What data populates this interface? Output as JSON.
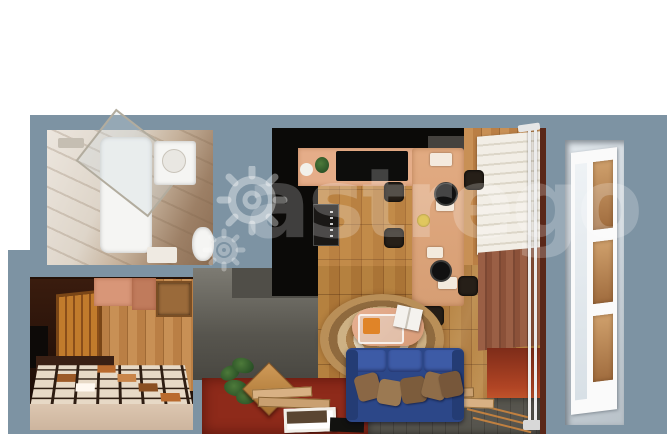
{
  "meta": {
    "type": "3d-floorplan-render",
    "subject": "Top-down 3D render of a furnished studio apartment with balcony",
    "canvas": {
      "width": 670,
      "height": 434
    }
  },
  "watermark": {
    "text": "astrego",
    "icon": "gear-icons",
    "color": "rgba(255,255,255,0.22)"
  },
  "colors": {
    "bg": "#ffffff",
    "slate": "#7d93a3",
    "black": "#0b0a08",
    "tub-white": "#f5f5f3",
    "counter-peach": "#e5ad89",
    "table-peach": "#dfa67e",
    "wood-mid": "#b5813f",
    "wood-light": "#c89055",
    "shade-white": "#f1ede4",
    "curtain-brown": "#8b5139",
    "balcony-red": "#b04424",
    "sofa-blue": "#2c4788",
    "pillow-brown": "#8a6745",
    "rug-tan": "#c19a63",
    "rug-cream": "#e6d9bd",
    "carpet-red": "#8e2a1a",
    "plank-gray": "#53514a",
    "tile-beige": "#d5bfa9",
    "door-orange": "#c17b2c",
    "hall-dark": "#33180e",
    "window-sky": "#d8dfe5",
    "frame-white": "#fafafa"
  },
  "rooms": {
    "bathroom": {
      "features": [
        "marble-tile",
        "bathtub",
        "glass-shower-screen",
        "vanity-sink",
        "toilet",
        "bath-mat"
      ]
    },
    "kitchen": {
      "features": [
        "black-wall-cabinets",
        "extractor-hood",
        "oven-column",
        "peach-countertop",
        "cooktop",
        "dining-table",
        "bar-stools",
        "plates",
        "pans",
        "plants"
      ]
    },
    "living-room": {
      "features": [
        "wood-plank-floor",
        "oval-jute-rug",
        "coffee-table",
        "glass-tray",
        "magazine",
        "blue-sofa",
        "throw-pillows",
        "red-carpet",
        "picture-frames",
        "houseplant",
        "serving-board",
        "gray-plank-rug"
      ]
    },
    "hallway": {
      "features": [
        "orange-slatted-door",
        "wall-cabinets",
        "mirror",
        "bench",
        "checkered-tile-floor",
        "wood-wall"
      ]
    },
    "balcony": {
      "features": [
        "roman-shade",
        "brown-curtain",
        "vertical-radiator",
        "red-sunlit-floor",
        "exterior-window"
      ]
    }
  }
}
